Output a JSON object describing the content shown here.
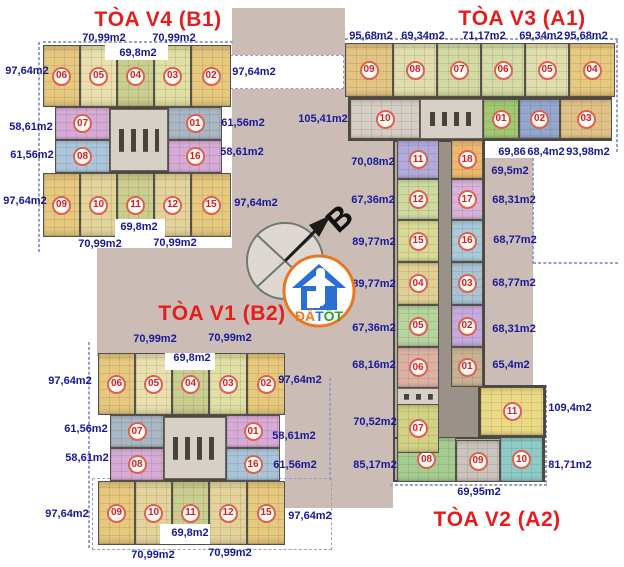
{
  "titles": [
    {
      "text": "TÒA V4 (B1)",
      "x": 158,
      "y": 20
    },
    {
      "text": "TÒA V3 (A1)",
      "x": 522,
      "y": 19
    },
    {
      "text": "TÒA V1 (B2)",
      "x": 222,
      "y": 314
    },
    {
      "text": "TÒA V2 (A2)",
      "x": 497,
      "y": 520
    }
  ],
  "compass": {
    "letter": "B"
  },
  "logo": {
    "part1": "ĐẤ",
    "part2": "T",
    "part3": "ỐT",
    "color1": "#f07a1e",
    "color2": "#2b6fd4",
    "color3": "#28a228",
    "ring": "#e87722"
  },
  "colors": {
    "title_red": "#e81c1c",
    "label_navy": "#18189a",
    "courtyard_beige": "#cbbdb5",
    "wall_gray": "#4c4840",
    "badge_red": "#d42020"
  },
  "area_labels": [
    {
      "text": "70,99m2",
      "x": 104,
      "y": 38
    },
    {
      "text": "70,99m2",
      "x": 174,
      "y": 38
    },
    {
      "text": "69,8m2",
      "x": 138,
      "y": 53
    },
    {
      "text": "97,64m2",
      "x": 27,
      "y": 71
    },
    {
      "text": "97,64m2",
      "x": 254,
      "y": 72
    },
    {
      "text": "58,61m2",
      "x": 31,
      "y": 127
    },
    {
      "text": "61,56m2",
      "x": 243,
      "y": 123
    },
    {
      "text": "61,56m2",
      "x": 32,
      "y": 155
    },
    {
      "text": "58,61m2",
      "x": 242,
      "y": 152
    },
    {
      "text": "97,64m2",
      "x": 25,
      "y": 201
    },
    {
      "text": "97,64m2",
      "x": 256,
      "y": 203
    },
    {
      "text": "69,8m2",
      "x": 139,
      "y": 227
    },
    {
      "text": "70,99m2",
      "x": 100,
      "y": 244
    },
    {
      "text": "70,99m2",
      "x": 175,
      "y": 243
    },
    {
      "text": "95,68m2",
      "x": 371,
      "y": 36
    },
    {
      "text": "69,34m2",
      "x": 423,
      "y": 36
    },
    {
      "text": "71,17m2",
      "x": 484,
      "y": 36
    },
    {
      "text": "69,34m2",
      "x": 541,
      "y": 36
    },
    {
      "text": "95,68m2",
      "x": 586,
      "y": 36
    },
    {
      "text": "105,41m2",
      "x": 323,
      "y": 119
    },
    {
      "text": "69,86",
      "x": 512,
      "y": 152
    },
    {
      "text": "68,4m2",
      "x": 546,
      "y": 152
    },
    {
      "text": "93,98m2",
      "x": 588,
      "y": 152
    },
    {
      "text": "70,08m2",
      "x": 373,
      "y": 162
    },
    {
      "text": "69,5m2",
      "x": 510,
      "y": 171
    },
    {
      "text": "67,36m2",
      "x": 373,
      "y": 200
    },
    {
      "text": "68,31m2",
      "x": 514,
      "y": 200
    },
    {
      "text": "89,77m2",
      "x": 374,
      "y": 242
    },
    {
      "text": "68,77m2",
      "x": 515,
      "y": 240
    },
    {
      "text": "89,77m2",
      "x": 374,
      "y": 284
    },
    {
      "text": "68,77m2",
      "x": 514,
      "y": 283
    },
    {
      "text": "67,36m2",
      "x": 374,
      "y": 328
    },
    {
      "text": "68,31m2",
      "x": 514,
      "y": 329
    },
    {
      "text": "68,16m2",
      "x": 374,
      "y": 365
    },
    {
      "text": "65,4m2",
      "x": 511,
      "y": 365
    },
    {
      "text": "70,52m2",
      "x": 375,
      "y": 422
    },
    {
      "text": "109,4m2",
      "x": 570,
      "y": 408
    },
    {
      "text": "85,17m2",
      "x": 375,
      "y": 465
    },
    {
      "text": "81,71m2",
      "x": 570,
      "y": 465
    },
    {
      "text": "69,95m2",
      "x": 479,
      "y": 492
    },
    {
      "text": "70,99m2",
      "x": 155,
      "y": 339
    },
    {
      "text": "70,99m2",
      "x": 230,
      "y": 338
    },
    {
      "text": "69,8m2",
      "x": 192,
      "y": 358
    },
    {
      "text": "97,64m2",
      "x": 70,
      "y": 381
    },
    {
      "text": "97,64m2",
      "x": 300,
      "y": 380
    },
    {
      "text": "61,56m2",
      "x": 86,
      "y": 429
    },
    {
      "text": "58,61m2",
      "x": 294,
      "y": 436
    },
    {
      "text": "58,61m2",
      "x": 87,
      "y": 458
    },
    {
      "text": "61,56m2",
      "x": 295,
      "y": 465
    },
    {
      "text": "97,64m2",
      "x": 67,
      "y": 514
    },
    {
      "text": "97,64m2",
      "x": 310,
      "y": 516
    },
    {
      "text": "69,8m2",
      "x": 190,
      "y": 533
    },
    {
      "text": "70,99m2",
      "x": 153,
      "y": 555
    },
    {
      "text": "70,99m2",
      "x": 230,
      "y": 553
    }
  ],
  "background_rects": [
    {
      "x": 232,
      "y": 8,
      "w": 113,
      "h": 92
    },
    {
      "x": 232,
      "y": 97,
      "w": 161,
      "h": 158
    },
    {
      "x": 97,
      "y": 248,
      "w": 296,
      "h": 108
    },
    {
      "x": 285,
      "y": 356,
      "w": 108,
      "h": 152
    },
    {
      "x": 345,
      "y": 97,
      "w": 48,
      "h": 403
    },
    {
      "x": 483,
      "y": 158,
      "w": 50,
      "h": 322
    }
  ],
  "dashed_lines": [
    {
      "x": 38,
      "y": 42,
      "w": 2,
      "h": 210
    },
    {
      "x": 43,
      "y": 41,
      "w": 190,
      "h": 2
    },
    {
      "x": 230,
      "y": 55,
      "w": 114,
      "h": 34,
      "fill": "#ffffff"
    },
    {
      "x": 345,
      "y": 38,
      "w": 273,
      "h": 2
    },
    {
      "x": 616,
      "y": 40,
      "w": 2,
      "h": 112
    },
    {
      "x": 532,
      "y": 158,
      "w": 2,
      "h": 106
    },
    {
      "x": 533,
      "y": 262,
      "w": 85,
      "h": 2
    },
    {
      "x": 545,
      "y": 385,
      "w": 2,
      "h": 98
    },
    {
      "x": 88,
      "y": 342,
      "w": 2,
      "h": 206
    },
    {
      "x": 92,
      "y": 478,
      "w": 240,
      "h": 72
    },
    {
      "x": 329,
      "y": 378,
      "w": 2,
      "h": 102
    },
    {
      "x": 390,
      "y": 484,
      "w": 157,
      "h": 2
    }
  ],
  "slabs": [
    {
      "x": 43,
      "y": 45,
      "w": 188,
      "h": 62
    },
    {
      "x": 55,
      "y": 107,
      "w": 167,
      "h": 66
    },
    {
      "x": 43,
      "y": 173,
      "w": 188,
      "h": 64
    },
    {
      "x": 345,
      "y": 43,
      "w": 270,
      "h": 54
    },
    {
      "x": 348,
      "y": 97,
      "w": 264,
      "h": 44
    },
    {
      "x": 393,
      "y": 140,
      "w": 92,
      "h": 300
    },
    {
      "x": 478,
      "y": 385,
      "w": 68,
      "h": 53
    },
    {
      "x": 393,
      "y": 437,
      "w": 152,
      "h": 45
    },
    {
      "x": 98,
      "y": 353,
      "w": 187,
      "h": 62
    },
    {
      "x": 110,
      "y": 415,
      "w": 170,
      "h": 66
    },
    {
      "x": 98,
      "y": 481,
      "w": 187,
      "h": 64
    }
  ],
  "corridors": [
    {
      "x": 439,
      "y": 142,
      "w": 12,
      "h": 296
    },
    {
      "x": 451,
      "y": 387,
      "w": 27,
      "h": 50
    }
  ],
  "cores": [
    {
      "x": 110,
      "y": 109,
      "w": 58,
      "h": 62
    },
    {
      "x": 420,
      "y": 99,
      "w": 63,
      "h": 40
    },
    {
      "x": 397,
      "y": 388,
      "w": 42,
      "h": 17
    },
    {
      "x": 164,
      "y": 417,
      "w": 62,
      "h": 62
    }
  ],
  "units": [
    {
      "b": "V4",
      "n": "06",
      "x": 43,
      "y": 45,
      "w": 37,
      "h": 62,
      "c": "#e6c87e"
    },
    {
      "b": "V4",
      "n": "05",
      "x": 80,
      "y": 45,
      "w": 37,
      "h": 62,
      "c": "#e9e0ae"
    },
    {
      "b": "V4",
      "n": "04",
      "x": 117,
      "y": 45,
      "w": 37,
      "h": 62,
      "c": "#c9cd8e"
    },
    {
      "b": "V4",
      "n": "03",
      "x": 154,
      "y": 45,
      "w": 37,
      "h": 62,
      "c": "#e0dfa4"
    },
    {
      "b": "V4",
      "n": "02",
      "x": 191,
      "y": 45,
      "w": 40,
      "h": 62,
      "c": "#e6c87e"
    },
    {
      "b": "V4",
      "n": "07",
      "x": 55,
      "y": 107,
      "w": 55,
      "h": 33,
      "c": "#d7abd7"
    },
    {
      "b": "V4",
      "n": "08",
      "x": 55,
      "y": 140,
      "w": 55,
      "h": 33,
      "c": "#abc6dc"
    },
    {
      "b": "V4",
      "n": "01",
      "x": 168,
      "y": 107,
      "w": 54,
      "h": 33,
      "c": "#a9b6c4"
    },
    {
      "b": "V4",
      "n": "16",
      "x": 168,
      "y": 140,
      "w": 54,
      "h": 33,
      "c": "#d7abd7"
    },
    {
      "b": "V4",
      "n": "09",
      "x": 43,
      "y": 173,
      "w": 37,
      "h": 64,
      "c": "#e6c87e"
    },
    {
      "b": "V4",
      "n": "10",
      "x": 80,
      "y": 173,
      "w": 37,
      "h": 64,
      "c": "#e3d49c"
    },
    {
      "b": "V4",
      "n": "11",
      "x": 117,
      "y": 173,
      "w": 37,
      "h": 64,
      "c": "#c9cd8e"
    },
    {
      "b": "V4",
      "n": "12",
      "x": 154,
      "y": 173,
      "w": 37,
      "h": 64,
      "c": "#e3d49c"
    },
    {
      "b": "V4",
      "n": "15",
      "x": 191,
      "y": 173,
      "w": 40,
      "h": 64,
      "c": "#e6c87e"
    },
    {
      "b": "V3",
      "n": "09",
      "x": 345,
      "y": 43,
      "w": 48,
      "h": 54,
      "c": "#e2c382"
    },
    {
      "b": "V3",
      "n": "08",
      "x": 393,
      "y": 43,
      "w": 44,
      "h": 54,
      "c": "#e0ddae"
    },
    {
      "b": "V3",
      "n": "07",
      "x": 437,
      "y": 43,
      "w": 44,
      "h": 54,
      "c": "#d2d9a2"
    },
    {
      "b": "V3",
      "n": "06",
      "x": 481,
      "y": 43,
      "w": 44,
      "h": 54,
      "c": "#d5dba6"
    },
    {
      "b": "V3",
      "n": "05",
      "x": 525,
      "y": 43,
      "w": 44,
      "h": 54,
      "c": "#e0ddae"
    },
    {
      "b": "V3",
      "n": "04",
      "x": 569,
      "y": 43,
      "w": 46,
      "h": 54,
      "c": "#e6c87e"
    },
    {
      "b": "V3",
      "n": "10",
      "x": 350,
      "y": 99,
      "w": 70,
      "h": 40,
      "c": "#d6cec4"
    },
    {
      "b": "V3",
      "n": "01",
      "x": 483,
      "y": 99,
      "w": 36,
      "h": 40,
      "c": "#a2c873"
    },
    {
      "b": "V3",
      "n": "02",
      "x": 519,
      "y": 99,
      "w": 41,
      "h": 40,
      "c": "#93a8cf"
    },
    {
      "b": "V3",
      "n": "03",
      "x": 560,
      "y": 99,
      "w": 52,
      "h": 40,
      "c": "#e0c288"
    },
    {
      "b": "V3/V2",
      "n": "11",
      "x": 397,
      "y": 140,
      "w": 42,
      "h": 39,
      "c": "#b2aada"
    },
    {
      "b": "V3/V2",
      "n": "12",
      "x": 397,
      "y": 179,
      "w": 42,
      "h": 41,
      "c": "#cedaa2"
    },
    {
      "b": "V3/V2",
      "n": "15",
      "x": 397,
      "y": 220,
      "w": 42,
      "h": 42,
      "c": "#dada96"
    },
    {
      "b": "V3/V2",
      "n": "04",
      "x": 397,
      "y": 262,
      "w": 42,
      "h": 43,
      "c": "#e0d096"
    },
    {
      "b": "V3/V2",
      "n": "05",
      "x": 397,
      "y": 305,
      "w": 42,
      "h": 42,
      "c": "#b5d49e"
    },
    {
      "b": "V3/V2",
      "n": "06",
      "x": 397,
      "y": 347,
      "w": 42,
      "h": 41,
      "c": "#dcb2a4"
    },
    {
      "b": "V3/V2",
      "n": "18",
      "x": 451,
      "y": 140,
      "w": 32,
      "h": 39,
      "c": "#eab86e"
    },
    {
      "b": "V3/V2",
      "n": "17",
      "x": 451,
      "y": 179,
      "w": 32,
      "h": 41,
      "c": "#d8b2da"
    },
    {
      "b": "V3/V2",
      "n": "16",
      "x": 451,
      "y": 220,
      "w": 32,
      "h": 42,
      "c": "#a8cada"
    },
    {
      "b": "V3/V2",
      "n": "03",
      "x": 451,
      "y": 262,
      "w": 32,
      "h": 43,
      "c": "#a9c2d4"
    },
    {
      "b": "V3/V2",
      "n": "02",
      "x": 451,
      "y": 305,
      "w": 32,
      "h": 42,
      "c": "#c4aade"
    },
    {
      "b": "V3/V2",
      "n": "01",
      "x": 451,
      "y": 347,
      "w": 32,
      "h": 40,
      "c": "#c9b194"
    },
    {
      "b": "V2",
      "n": "08",
      "x": 397,
      "y": 437,
      "w": 59,
      "h": 45,
      "c": "#a5cd92"
    },
    {
      "b": "V2",
      "n": "09",
      "x": 456,
      "y": 440,
      "w": 44,
      "h": 42,
      "c": "#c9c4bc"
    },
    {
      "b": "V2",
      "n": "10",
      "x": 500,
      "y": 437,
      "w": 43,
      "h": 45,
      "c": "#8fcbc6"
    },
    {
      "b": "V2",
      "n": "11",
      "x": 480,
      "y": 387,
      "w": 64,
      "h": 49,
      "c": "#ead985"
    },
    {
      "b": "V2",
      "n": "07",
      "x": 397,
      "y": 404,
      "w": 42,
      "h": 49,
      "c": "#d2d284"
    },
    {
      "b": "V1",
      "n": "06",
      "x": 98,
      "y": 353,
      "w": 37,
      "h": 62,
      "c": "#e6c87e"
    },
    {
      "b": "V1",
      "n": "05",
      "x": 135,
      "y": 353,
      "w": 37,
      "h": 62,
      "c": "#e9e0ae"
    },
    {
      "b": "V1",
      "n": "04",
      "x": 172,
      "y": 353,
      "w": 37,
      "h": 62,
      "c": "#c9cd8e"
    },
    {
      "b": "V1",
      "n": "03",
      "x": 209,
      "y": 353,
      "w": 38,
      "h": 62,
      "c": "#e0dfa4"
    },
    {
      "b": "V1",
      "n": "02",
      "x": 247,
      "y": 353,
      "w": 38,
      "h": 62,
      "c": "#e6c87e"
    },
    {
      "b": "V1",
      "n": "07",
      "x": 110,
      "y": 415,
      "w": 54,
      "h": 33,
      "c": "#a9b6c4"
    },
    {
      "b": "V1",
      "n": "08",
      "x": 110,
      "y": 448,
      "w": 54,
      "h": 33,
      "c": "#d7abd7"
    },
    {
      "b": "V1",
      "n": "01",
      "x": 226,
      "y": 415,
      "w": 54,
      "h": 33,
      "c": "#d7abd7"
    },
    {
      "b": "V1",
      "n": "16",
      "x": 226,
      "y": 448,
      "w": 54,
      "h": 33,
      "c": "#a8c4d8"
    },
    {
      "b": "V1",
      "n": "09",
      "x": 98,
      "y": 481,
      "w": 37,
      "h": 64,
      "c": "#e6c87e"
    },
    {
      "b": "V1",
      "n": "10",
      "x": 135,
      "y": 481,
      "w": 37,
      "h": 64,
      "c": "#e3d49c"
    },
    {
      "b": "V1",
      "n": "11",
      "x": 172,
      "y": 481,
      "w": 37,
      "h": 64,
      "c": "#c9cd8e"
    },
    {
      "b": "V1",
      "n": "12",
      "x": 209,
      "y": 481,
      "w": 38,
      "h": 64,
      "c": "#e3d49c"
    },
    {
      "b": "V1",
      "n": "15",
      "x": 247,
      "y": 481,
      "w": 38,
      "h": 64,
      "c": "#e6c87e"
    }
  ],
  "notches": [
    {
      "x": 105,
      "y": 43,
      "w": 63,
      "h": 17
    },
    {
      "x": 115,
      "y": 219,
      "w": 50,
      "h": 18
    },
    {
      "x": 165,
      "y": 353,
      "w": 50,
      "h": 17
    },
    {
      "x": 160,
      "y": 524,
      "w": 50,
      "h": 20
    }
  ]
}
